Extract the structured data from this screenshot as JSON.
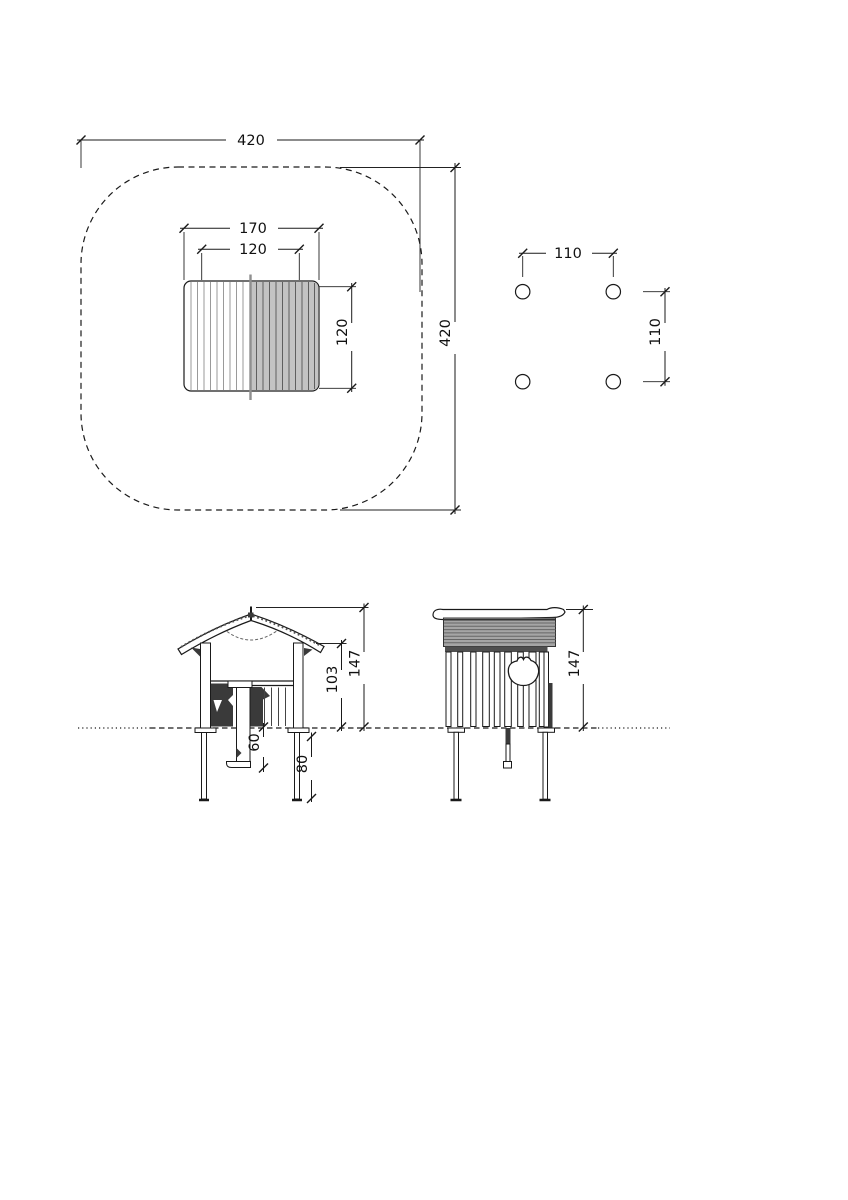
{
  "colors": {
    "ink": "#1a1a1a",
    "dark_panel": "#3a3a3a",
    "roof_plan_gray": "#c3c3c3",
    "roof_side_gray": "#a5a5a5",
    "fascia_gray": "#4f4f4f"
  },
  "views": {
    "plan": {
      "dims": {
        "safety_width": "420",
        "safety_depth": "420",
        "roof_width": "170",
        "house_width": "120",
        "house_depth": "120"
      }
    },
    "post_layout": {
      "dims": {
        "spacing_width": "110",
        "spacing_depth": "110"
      }
    },
    "front_elevation": {
      "dims": {
        "total_height": "147",
        "wall_height": "103",
        "step_depth": "60",
        "foundation_depth": "80"
      }
    },
    "side_elevation": {
      "dims": {
        "total_height": "147"
      }
    }
  }
}
